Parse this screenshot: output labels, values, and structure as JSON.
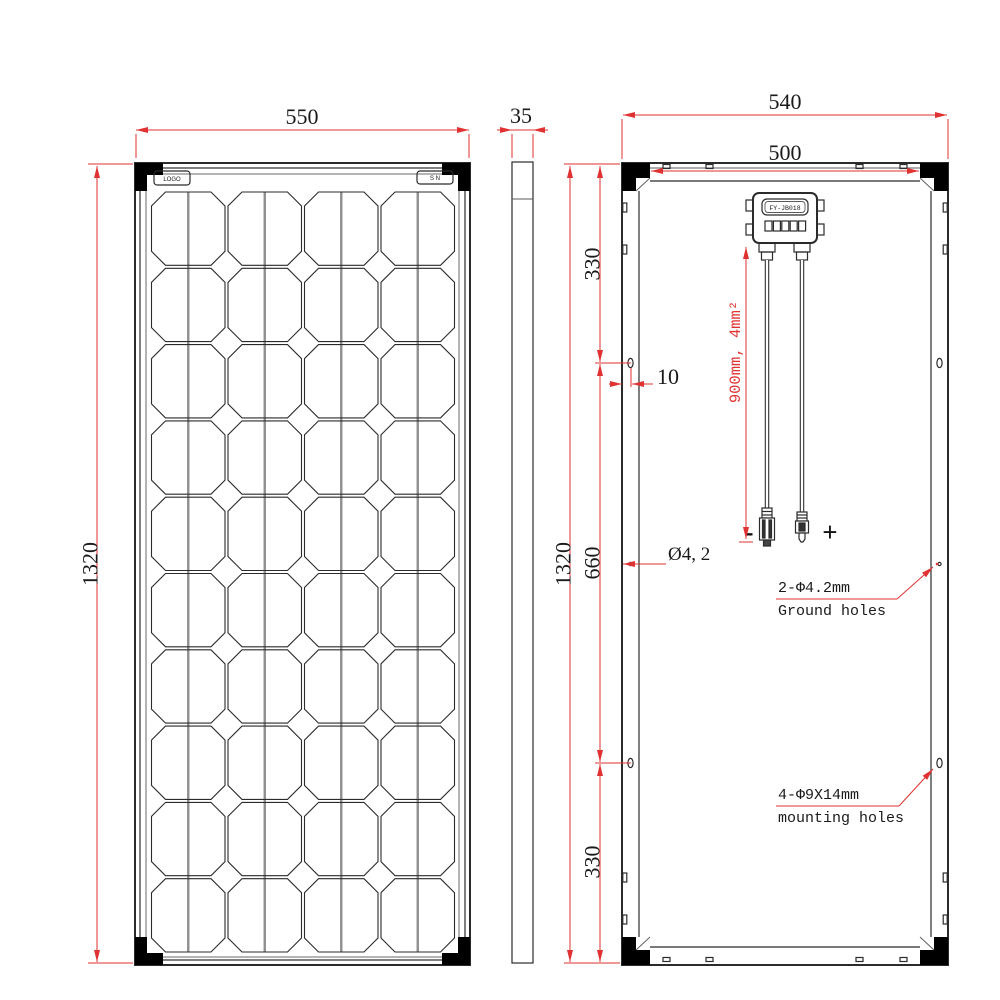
{
  "front_view": {
    "width_dim": "550",
    "height_dim": "1320",
    "logo_label": "LOGO",
    "serial_label": "S N",
    "grid": {
      "columns": 4,
      "rows": 10,
      "cell_shape": "octagon",
      "busbars_per_cell": 1
    }
  },
  "side_view": {
    "thickness_dim": "35"
  },
  "back_view": {
    "outer_width_dim": "540",
    "inner_width_dim": "500",
    "height_dim": "1320",
    "top_mount_offset_dim": "330",
    "mid_span_dim": "660",
    "bottom_mount_offset_dim": "330",
    "ground_hole_edge_offset_dim": "10",
    "ground_hole_diameter_dim": "Ø4, 2",
    "junction_box_model": "FY-JB018",
    "cable_spec": "900mm, 4mm²",
    "negative_label": "-",
    "positive_label": "+",
    "ground_holes_note": [
      "2-Φ4.2mm",
      "Ground holes"
    ],
    "mounting_holes_note": [
      "4-Φ9X14mm",
      "mounting holes"
    ]
  },
  "colors": {
    "dimension_red": "#e03232",
    "outline_black": "#2b2b2b",
    "busbar_gray": "#8f8f8f",
    "bracket_black": "#000000"
  }
}
